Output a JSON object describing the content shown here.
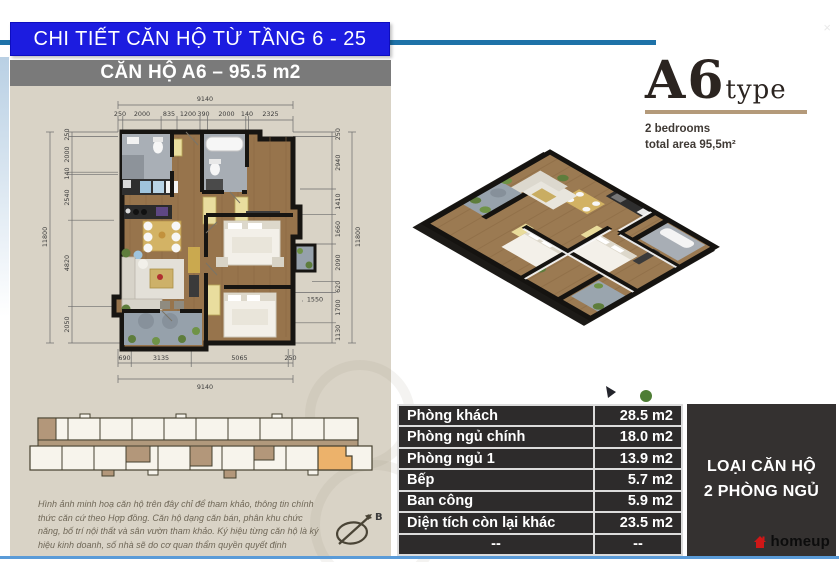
{
  "banner": {
    "title": "CHI TIẾT CĂN HỘ TỪ TẦNG 6 - 25"
  },
  "close_glyph": "×",
  "plan": {
    "header": "CĂN HỘ A6 – 95.5 m2",
    "dims": {
      "top_total": "9140",
      "top": [
        "250",
        "2000",
        "835",
        "1200",
        "390",
        "2000",
        "140",
        "2325"
      ],
      "left_total": "11800",
      "left": [
        "250",
        "2000",
        "140",
        "2540",
        "4820",
        "2050"
      ],
      "right_total": "11800",
      "right": [
        "250",
        "2940",
        "1410",
        "1660",
        "2090",
        "620",
        "1700",
        "1130"
      ],
      "bottom_total": "9140",
      "bottom": [
        "690",
        "3135",
        "5065",
        "250"
      ],
      "inner": "1550"
    }
  },
  "type_block": {
    "code": "A6",
    "word": "type",
    "bedrooms": "2 bedrooms",
    "area": "total area 95,5m²"
  },
  "table": {
    "rows": [
      {
        "label": "Phòng khách",
        "value": "28.5 m2"
      },
      {
        "label": "Phòng ngủ chính",
        "value": "18.0 m2"
      },
      {
        "label": "Phòng ngủ 1",
        "value": "13.9 m2"
      },
      {
        "label": "Bếp",
        "value": "5.7 m2"
      },
      {
        "label": "Ban công",
        "value": "5.9 m2"
      },
      {
        "label": "Diện tích còn lại khác",
        "value": "23.5 m2"
      },
      {
        "label": "--",
        "value": "--"
      }
    ]
  },
  "unit_box": {
    "line1": "LOẠI CĂN HỘ",
    "line2": "2 PHÒNG NGỦ"
  },
  "brand": {
    "name": "homeup"
  },
  "compass": {
    "label": "B"
  },
  "disclaimer": "Hình ảnh minh hoạ căn hộ trên đây chỉ để tham khảo, thông tin chính thức căn cứ theo Hợp đồng. Căn hộ dạng căn bán, phân khu chức năng, bố trí nội thất và sân vườn tham khảo. Ký hiệu từng căn hộ là ký hiệu kinh doanh, số nhà sẽ do cơ quan thẩm quyền quyết định",
  "colors": {
    "banner_blue": "#1c1ce0",
    "teal_rule": "#1e72a8",
    "panel_beige": "#d9d3c6",
    "header_gray": "#7a7a7a",
    "table_dark": "#2d2b2b",
    "accent_tan": "#b49a7a",
    "highlight_orange": "#ecb26b",
    "brand_red": "#cf1717",
    "bottom_blue": "#5a9bd8"
  }
}
